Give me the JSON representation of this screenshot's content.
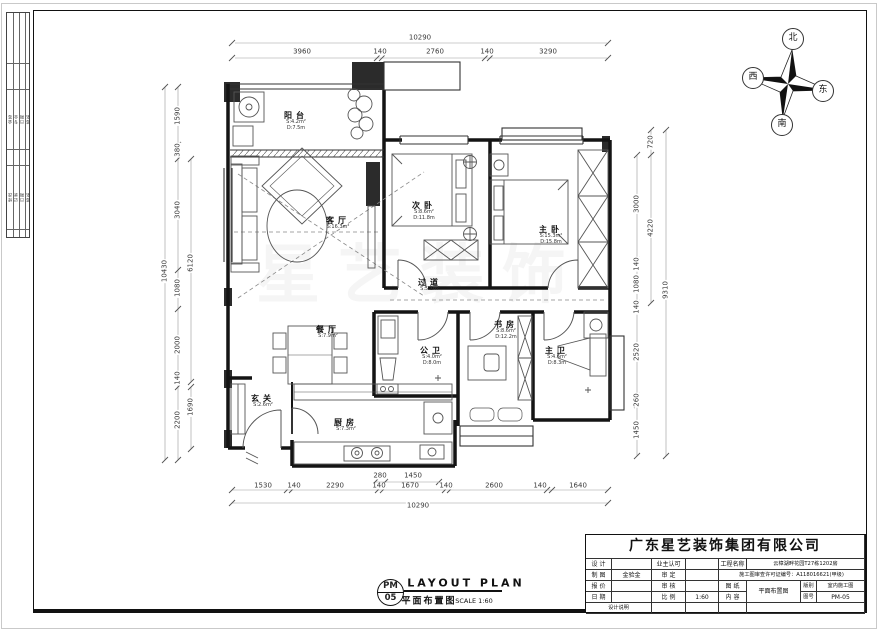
{
  "compass": {
    "north": "北",
    "south": "南",
    "east": "东",
    "west": "西"
  },
  "watermark": "星艺装饰",
  "rooms": {
    "balcony": {
      "name": "阳台",
      "a1": "S:4.2m²",
      "a2": "D:7.5m"
    },
    "living": {
      "name": "客厅",
      "a1": "S:16.3m²",
      "a2": ""
    },
    "bed2": {
      "name": "次卧",
      "a1": "S:8.6m²",
      "a2": "D:11.8m"
    },
    "master": {
      "name": "主卧",
      "a1": "S:15.3m²",
      "a2": "D:15.8m"
    },
    "corridor": {
      "name": "过道",
      "a1": "S:5.1m²",
      "a2": ""
    },
    "dining": {
      "name": "餐厅",
      "a1": "S:7.9m²",
      "a2": ""
    },
    "study": {
      "name": "书房",
      "a1": "S:8.6m²",
      "a2": "D:12.2m"
    },
    "bath": {
      "name": "公卫",
      "a1": "S:4.0m²",
      "a2": "D:8.0m"
    },
    "mbath": {
      "name": "主卫",
      "a1": "S:4.6m²",
      "a2": "D:8.3m"
    },
    "foyer": {
      "name": "玄关",
      "a1": "S:2.6m²",
      "a2": ""
    },
    "kitchen": {
      "name": "厨房",
      "a1": "S:7.3m²",
      "a2": ""
    }
  },
  "dims": {
    "top_total": "10290",
    "top": [
      "3960",
      "140",
      "2760",
      "140",
      "3290"
    ],
    "bottom_partial": [
      "280",
      "1450"
    ],
    "bottom": [
      "1530",
      "140",
      "2290",
      "140",
      "1670",
      "140",
      "2600",
      "140",
      "1640"
    ],
    "bottom_total": "10290",
    "left_total": "10430",
    "left": [
      "1590",
      "380",
      "3040",
      "1080",
      "2000",
      "140",
      "2200"
    ],
    "left_inner": [
      "6120",
      "1690"
    ],
    "right": [
      "3000",
      "140",
      "1080",
      "140",
      "2520",
      "260",
      "1450"
    ],
    "right_mid": [
      "720",
      "4220"
    ],
    "right_total": "9310"
  },
  "footer": {
    "code_top": "PM",
    "code_bottom": "05",
    "title_en": "LAYOUT PLAN",
    "title_cn": "平面布置图",
    "scale": "SCALE 1:60"
  },
  "tb": {
    "company": "广东星艺装饰集团有限公司",
    "design_label": "设 计",
    "owner_label": "业主认可",
    "project_label": "工程名称",
    "project_value": "云樟湖畔花园T27栋1202房",
    "draft_label": "制 图",
    "draft_value": "金验金",
    "approve_label": "审 定",
    "permit": "施工图审查许可证编号：A118016621(甲级)",
    "quote_label": "报 价",
    "check_label": "审 核",
    "sheet_label": "图 纸",
    "content_label": "内 容",
    "sheet_value": "平面布置图",
    "version_label": "版别",
    "version_value": "室内施工图",
    "date_label": "日 期",
    "scale_label": "比 例",
    "scale_value": "1:60",
    "no_label": "图号",
    "no_value": "PM-05",
    "note_label": "设计说明"
  },
  "strip": {
    "g1": [
      "会签",
      "专业",
      "日期",
      "签名"
    ],
    "g2": [
      "修改",
      "记录",
      "日期",
      "签名"
    ]
  }
}
